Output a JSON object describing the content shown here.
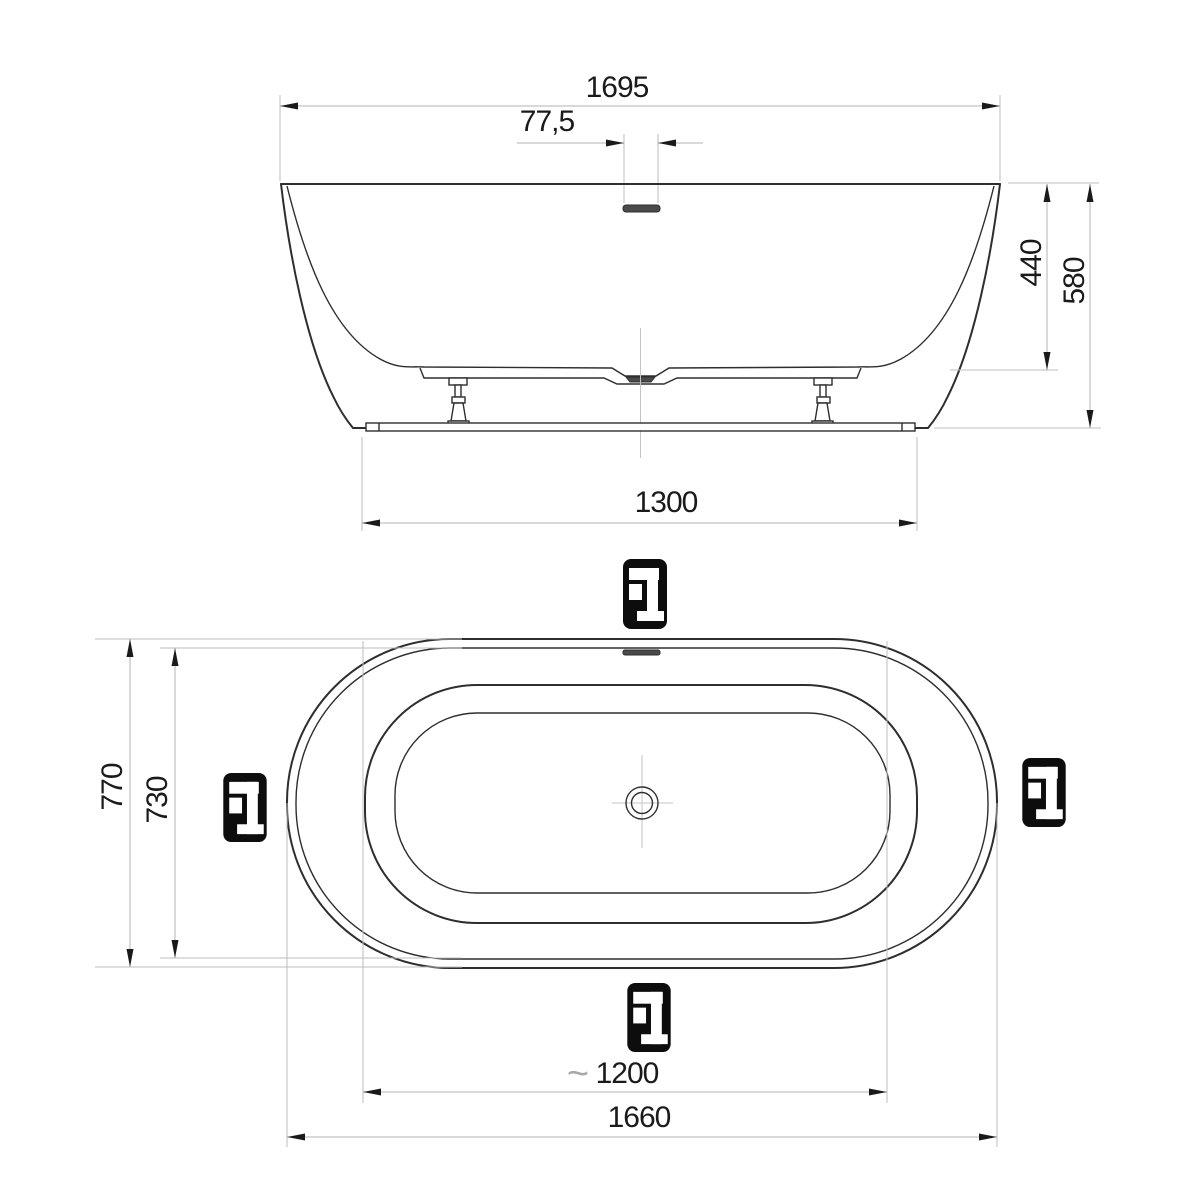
{
  "drawing": {
    "type": "technical-dimension-drawing",
    "subject": "freestanding oval bathtub, side elevation and plan view",
    "views": {
      "side": {
        "overall_length": "1695",
        "overflow_offset": "77,5",
        "inner_depth": "440",
        "overall_height": "580",
        "base_length": "1300"
      },
      "plan": {
        "overall_width": "770",
        "rim_inner_width": "730",
        "approx_symbol": "~",
        "inner_length": "1200",
        "overall_length": "1660"
      }
    },
    "icons": {
      "faucet_position_marker": "faucet-icon",
      "positions": [
        "top",
        "left",
        "right",
        "bottom"
      ]
    },
    "colors": {
      "outline": "#2e2e2e",
      "dimension_line": "#b3b3b3",
      "text": "#1a1a1a",
      "icon_background": "#0d0d0d",
      "drain_fill": "#4a4a4a"
    }
  }
}
